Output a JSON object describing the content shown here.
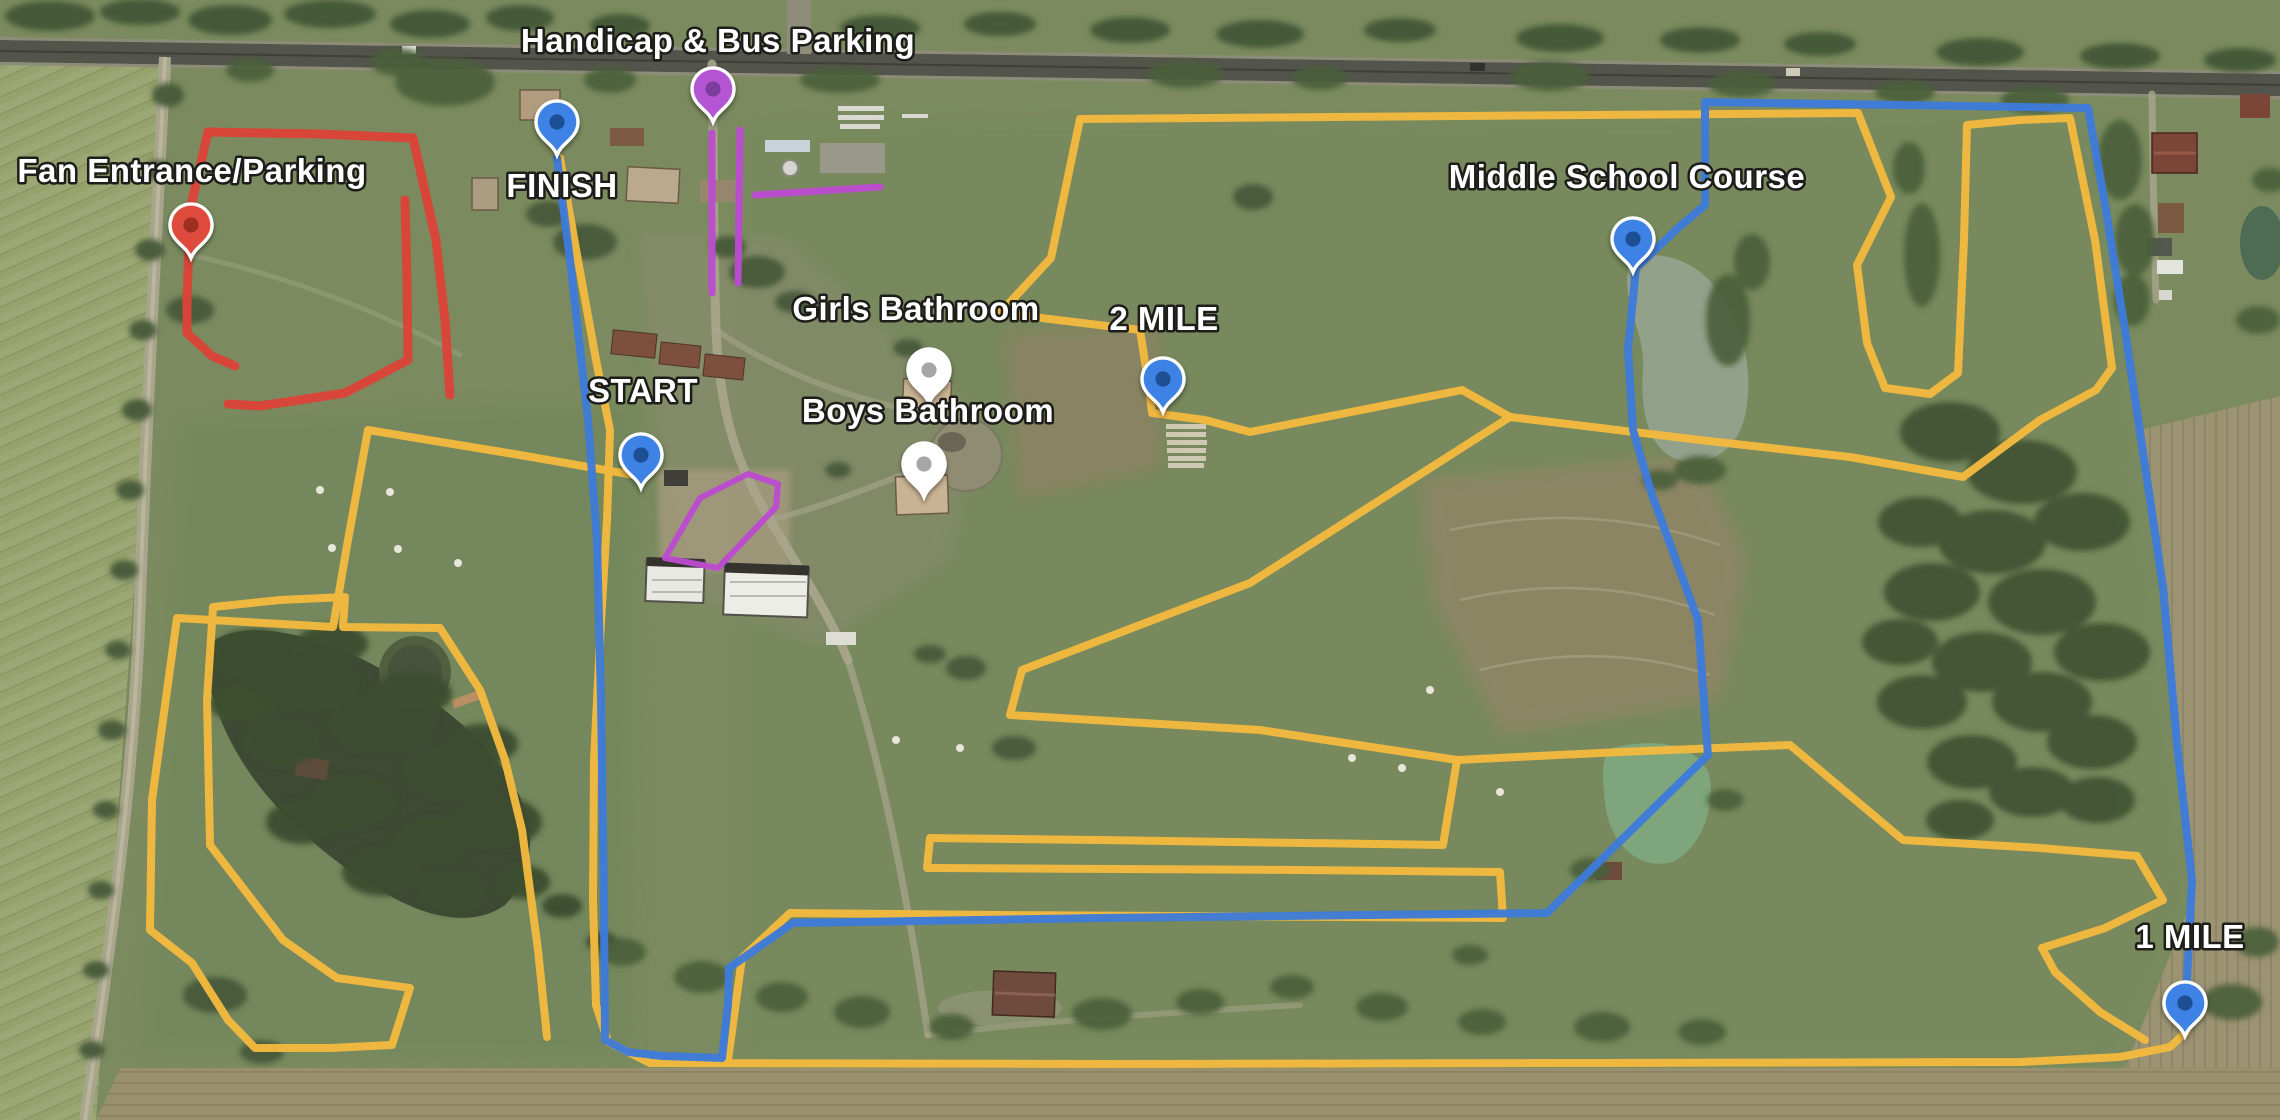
{
  "map": {
    "palette": {
      "yellow": "#F2B93E",
      "blue": "#3D7BDA",
      "red": "#DB4437",
      "purple": "#BB4BD0",
      "label_fill": "#ffffff",
      "label_outline": "#1d1d1a"
    },
    "labels": [
      {
        "id": "fan-entrance-parking",
        "text": "Fan Entrance/Parking",
        "x": 192,
        "y": 182
      },
      {
        "id": "finish",
        "text": "FINISH",
        "x": 562,
        "y": 197
      },
      {
        "id": "handicap-bus-parking",
        "text": "Handicap & Bus Parking",
        "x": 718,
        "y": 52
      },
      {
        "id": "start",
        "text": "START",
        "x": 643,
        "y": 402
      },
      {
        "id": "girls-bathroom",
        "text": "Girls Bathroom",
        "x": 916,
        "y": 320
      },
      {
        "id": "boys-bathroom",
        "text": "Boys Bathroom",
        "x": 928,
        "y": 422
      },
      {
        "id": "two-mile",
        "text": "2 MILE",
        "x": 1164,
        "y": 330
      },
      {
        "id": "middle-school-course",
        "text": "Middle School Course",
        "x": 1627,
        "y": 188
      },
      {
        "id": "one-mile",
        "text": "1 MILE",
        "x": 2190,
        "y": 948
      }
    ],
    "markers": [
      {
        "id": "fan-entrance-parking",
        "x": 191,
        "y": 258,
        "fill": "#DE4B3C",
        "dot": "#9C2F22"
      },
      {
        "id": "finish",
        "x": 557,
        "y": 155,
        "fill": "#3E82E4",
        "dot": "#1D4F93"
      },
      {
        "id": "handicap-bus-parking",
        "x": 713,
        "y": 122,
        "fill": "#B455D4",
        "dot": "#7C3C9E"
      },
      {
        "id": "start",
        "x": 641,
        "y": 488,
        "fill": "#3E82E4",
        "dot": "#1D4F93"
      },
      {
        "id": "girls-bathroom",
        "x": 929,
        "y": 403,
        "fill": "#FFFFFF",
        "dot": "#A6A6A6"
      },
      {
        "id": "boys-bathroom",
        "x": 924,
        "y": 497,
        "fill": "#FFFFFF",
        "dot": "#A6A6A6"
      },
      {
        "id": "two-mile",
        "x": 1163,
        "y": 412,
        "fill": "#3E82E4",
        "dot": "#1D4F93"
      },
      {
        "id": "middle-school-course",
        "x": 1633,
        "y": 272,
        "fill": "#3E82E4",
        "dot": "#1D4F93"
      },
      {
        "id": "one-mile",
        "x": 2185,
        "y": 1036,
        "fill": "#3E82E4",
        "dot": "#1D4F93"
      }
    ],
    "routes": [
      {
        "id": "varsity-finish-chute-and-south-boundary",
        "color": "yellow",
        "width": 8,
        "points": [
          [
            560,
            158
          ],
          [
            577,
            255
          ],
          [
            596,
            360
          ],
          [
            610,
            430
          ],
          [
            607,
            520
          ],
          [
            600,
            640
          ],
          [
            594,
            760
          ],
          [
            593,
            900
          ],
          [
            596,
            1005
          ],
          [
            608,
            1042
          ],
          [
            650,
            1063
          ],
          [
            1100,
            1064
          ],
          [
            1600,
            1063
          ],
          [
            2020,
            1062
          ],
          [
            2120,
            1057
          ],
          [
            2170,
            1047
          ],
          [
            2186,
            1032
          ]
        ]
      },
      {
        "id": "varsity-west-lake-loop",
        "color": "yellow",
        "width": 8,
        "points": [
          [
            645,
            477
          ],
          [
            520,
            455
          ],
          [
            368,
            430
          ],
          [
            348,
            540
          ],
          [
            333,
            627
          ],
          [
            177,
            618
          ],
          [
            152,
            800
          ],
          [
            150,
            930
          ],
          [
            192,
            963
          ],
          [
            228,
            1020
          ],
          [
            255,
            1048
          ],
          [
            330,
            1048
          ],
          [
            392,
            1045
          ],
          [
            410,
            988
          ],
          [
            337,
            978
          ],
          [
            283,
            940
          ],
          [
            210,
            845
          ],
          [
            207,
            700
          ],
          [
            213,
            607
          ],
          [
            280,
            600
          ],
          [
            345,
            597
          ],
          [
            343,
            627
          ],
          [
            440,
            628
          ],
          [
            480,
            690
          ],
          [
            505,
            760
          ],
          [
            522,
            830
          ],
          [
            538,
            950
          ],
          [
            547,
            1037
          ]
        ]
      },
      {
        "id": "varsity-north-and-east-loop",
        "color": "yellow",
        "width": 8,
        "points": [
          [
            1080,
            119
          ],
          [
            1460,
            116
          ],
          [
            1858,
            113
          ],
          [
            1891,
            197
          ],
          [
            1857,
            265
          ],
          [
            1867,
            343
          ],
          [
            1885,
            388
          ],
          [
            1930,
            394
          ],
          [
            1958,
            373
          ],
          [
            1964,
            240
          ],
          [
            1967,
            125
          ],
          [
            2020,
            120
          ],
          [
            2070,
            118
          ],
          [
            2095,
            240
          ],
          [
            2112,
            368
          ],
          [
            2096,
            390
          ],
          [
            2040,
            420
          ],
          [
            1963,
            477
          ],
          [
            1850,
            457
          ],
          [
            1700,
            440
          ],
          [
            1510,
            417
          ],
          [
            1250,
            583
          ],
          [
            1022,
            670
          ],
          [
            1010,
            715
          ],
          [
            1260,
            730
          ],
          [
            1457,
            760
          ],
          [
            1620,
            752
          ],
          [
            1790,
            745
          ],
          [
            1903,
            840
          ],
          [
            2040,
            848
          ],
          [
            2137,
            856
          ],
          [
            2163,
            900
          ],
          [
            2105,
            928
          ],
          [
            2042,
            948
          ],
          [
            2055,
            972
          ],
          [
            2100,
            1012
          ],
          [
            2145,
            1040
          ]
        ]
      },
      {
        "id": "varsity-two-mile-spur",
        "color": "yellow",
        "width": 8,
        "points": [
          [
            1080,
            119
          ],
          [
            1051,
            258
          ],
          [
            1000,
            313
          ],
          [
            1140,
            330
          ],
          [
            1150,
            395
          ],
          [
            1152,
            413
          ],
          [
            1205,
            420
          ],
          [
            1250,
            432
          ],
          [
            1462,
            390
          ],
          [
            1510,
            417
          ]
        ]
      },
      {
        "id": "varsity-switchbacks",
        "color": "yellow",
        "width": 8,
        "points": [
          [
            1457,
            760
          ],
          [
            1443,
            845
          ],
          [
            1100,
            840
          ],
          [
            930,
            838
          ],
          [
            927,
            868
          ],
          [
            1300,
            870
          ],
          [
            1500,
            872
          ],
          [
            1503,
            918
          ],
          [
            1000,
            915
          ],
          [
            790,
            913
          ],
          [
            742,
            958
          ],
          [
            728,
            1060
          ]
        ]
      },
      {
        "id": "middle-school-course-route",
        "color": "blue",
        "width": 8,
        "points": [
          [
            557,
            158
          ],
          [
            570,
            260
          ],
          [
            588,
            420
          ],
          [
            597,
            540
          ],
          [
            601,
            700
          ],
          [
            604,
            900
          ],
          [
            605,
            1040
          ],
          [
            628,
            1052
          ],
          [
            663,
            1056
          ],
          [
            722,
            1058
          ],
          [
            728,
            1005
          ],
          [
            729,
            968
          ],
          [
            793,
            923
          ],
          [
            1100,
            918
          ],
          [
            1547,
            913
          ],
          [
            1708,
            755
          ],
          [
            1698,
            620
          ],
          [
            1652,
            495
          ],
          [
            1633,
            430
          ],
          [
            1628,
            350
          ],
          [
            1636,
            268
          ],
          [
            1678,
            228
          ],
          [
            1705,
            205
          ],
          [
            1705,
            102
          ],
          [
            1900,
            105
          ],
          [
            2088,
            108
          ],
          [
            2106,
            210
          ],
          [
            2125,
            330
          ],
          [
            2140,
            432
          ],
          [
            2163,
            587
          ],
          [
            2177,
            743
          ],
          [
            2192,
            880
          ],
          [
            2186,
            1000
          ]
        ]
      },
      {
        "id": "fan-parking-outer-north",
        "color": "red",
        "width": 9,
        "points": [
          [
            208,
            132
          ],
          [
            320,
            134
          ],
          [
            413,
            138
          ],
          [
            436,
            240
          ],
          [
            445,
            320
          ],
          [
            450,
            395
          ]
        ]
      },
      {
        "id": "fan-parking-outer-west",
        "color": "red",
        "width": 9,
        "points": [
          [
            208,
            132
          ],
          [
            190,
            210
          ],
          [
            187,
            300
          ],
          [
            187,
            333
          ],
          [
            212,
            356
          ],
          [
            235,
            366
          ]
        ]
      },
      {
        "id": "fan-parking-inner",
        "color": "red",
        "width": 9,
        "points": [
          [
            405,
            200
          ],
          [
            407,
            280
          ],
          [
            408,
            360
          ],
          [
            345,
            393
          ],
          [
            260,
            406
          ],
          [
            228,
            404
          ]
        ]
      },
      {
        "id": "bus-lane-west",
        "color": "purple",
        "width": 7,
        "points": [
          [
            712,
            133
          ],
          [
            712,
            293
          ]
        ]
      },
      {
        "id": "bus-lane-east",
        "color": "purple",
        "width": 7,
        "points": [
          [
            740,
            130
          ],
          [
            738,
            283
          ]
        ]
      },
      {
        "id": "bus-lane-cross",
        "color": "purple",
        "width": 7,
        "points": [
          [
            755,
            195
          ],
          [
            880,
            187
          ]
        ]
      },
      {
        "id": "handicap-parking-pad",
        "color": "purple",
        "width": 6,
        "points": [
          [
            665,
            558
          ],
          [
            700,
            498
          ],
          [
            748,
            474
          ],
          [
            778,
            484
          ],
          [
            776,
            507
          ],
          [
            718,
            568
          ],
          [
            665,
            558
          ]
        ]
      }
    ]
  }
}
